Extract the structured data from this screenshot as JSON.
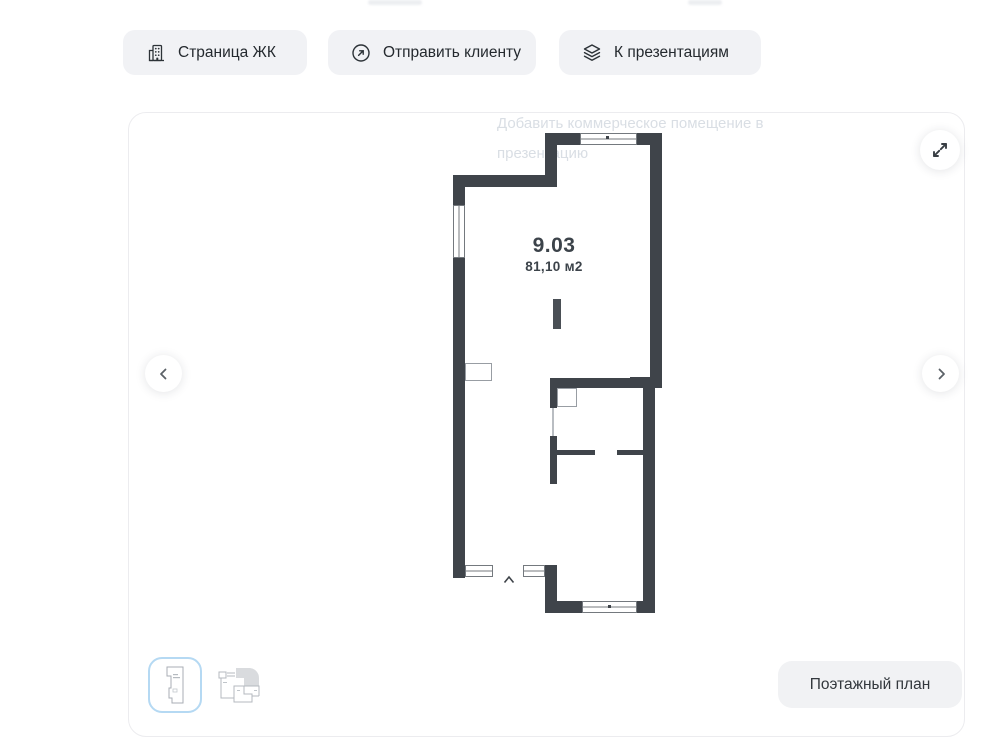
{
  "toolbar": {
    "page_button": "Страница ЖК",
    "send_button": "Отправить клиенту",
    "presentations_button": "К презентациям"
  },
  "viewer": {
    "ghost_hint_line1": "Добавить коммерческое помещение в",
    "ghost_hint_line2": "презентацию",
    "floor_plan_button": "Поэтажный план"
  },
  "unit": {
    "number": "9.03",
    "area": "81,10 м2"
  },
  "icons": {
    "building": "building-icon",
    "send": "arrow-up-right-circle-icon",
    "presentations": "layers-icon",
    "expand": "expand-arrows-icon",
    "prev": "chevron-left-icon",
    "next": "chevron-right-icon",
    "entrance": "entrance-caret-icon"
  },
  "colors": {
    "wall": "#3f444a",
    "ghost_text": "#d9dee4",
    "button_bg": "#f1f2f5",
    "selected_thumb_border": "#b5d9f3"
  }
}
